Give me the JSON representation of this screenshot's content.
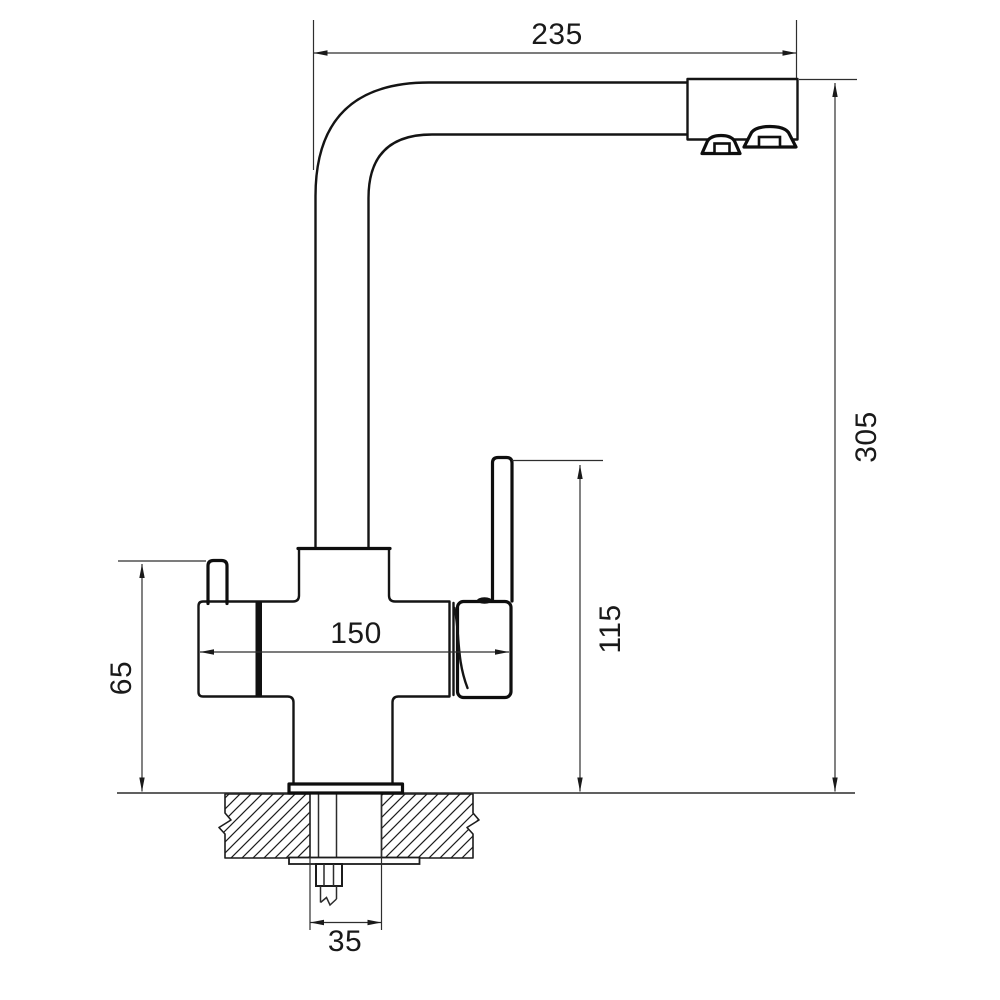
{
  "drawing": {
    "title": "faucet-dimension-drawing",
    "dimensions": {
      "spout_reach": "235",
      "overall_height": "305",
      "body_width": "150",
      "handle_height": "115",
      "left_lever_height": "65",
      "mount_hole_width": "35"
    },
    "colors": {
      "outline": "#141414",
      "dimension_lines": "#2e2e2e",
      "background": "#ffffff"
    }
  }
}
